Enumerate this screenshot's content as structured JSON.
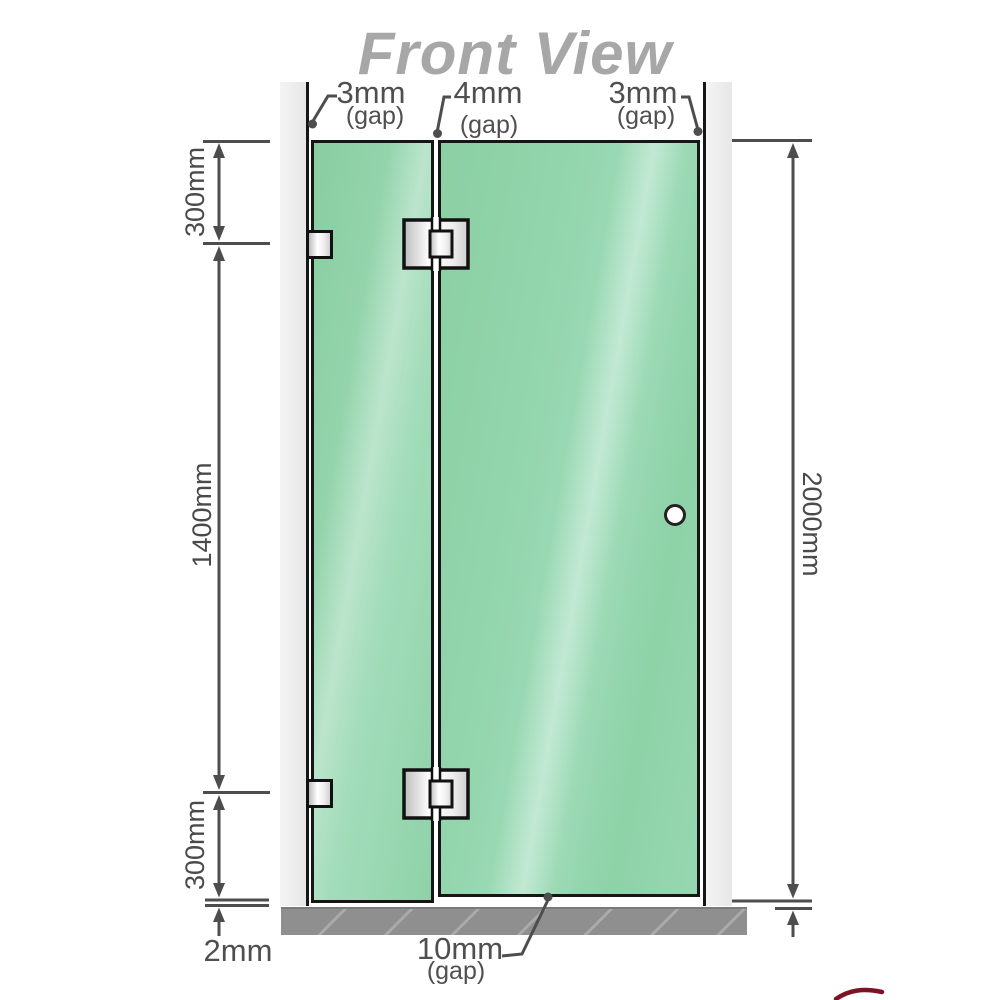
{
  "title": "Front View",
  "gaps": {
    "top_left": {
      "value": "3mm",
      "note": "(gap)"
    },
    "top_middle": {
      "value": "4mm",
      "note": "(gap)"
    },
    "top_right": {
      "value": "3mm",
      "note": "(gap)"
    },
    "bottom": {
      "value": "10mm",
      "note": "(gap)"
    },
    "floor_left": {
      "value": "2mm"
    }
  },
  "dimensions": {
    "left_top": "300mm",
    "left_middle": "1400mm",
    "left_bottom": "300mm",
    "right_overall": "2000mm"
  },
  "colors": {
    "glass_green": "#8ed1a8",
    "glass_highlight": "#c8edd9",
    "wall_gray": "#ececec",
    "floor_gray": "#8f8f8f",
    "dimension_gray": "#4d4d4d",
    "outline_black": "#161616",
    "title_gray": "#a7a7a7",
    "corner_red": "#7d1322"
  },
  "components": {
    "left_wall": "wall",
    "right_wall": "wall",
    "fixed_panel": "fixed glass panel",
    "door_panel": "hinged glass door",
    "hinge_count": 2,
    "wall_bracket_count": 2,
    "floor": "base / floor strip",
    "handle": "round door knob"
  }
}
